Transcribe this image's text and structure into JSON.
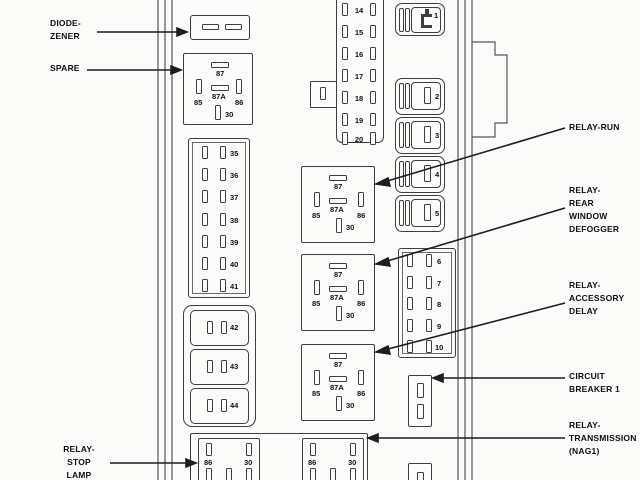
{
  "callouts": {
    "top_partial": "DIODE 2",
    "diode_zener": [
      "DIODE-",
      "ZENER"
    ],
    "spare": [
      "SPARE"
    ],
    "relay_run": [
      "RELAY-RUN"
    ],
    "rear_defogger": [
      "RELAY-",
      "REAR",
      "WINDOW",
      "DEFOGGER"
    ],
    "accessory_delay": [
      "RELAY-",
      "ACCESSORY",
      "DELAY"
    ],
    "circuit_breaker": [
      "CIRCUIT",
      "BREAKER 1"
    ],
    "transmission": [
      "RELAY-",
      "TRANSMISSION",
      "(NAG1)"
    ],
    "stop_lamp": [
      "RELAY-",
      "STOP",
      "LAMP"
    ]
  },
  "relay_pins": {
    "p87": "87",
    "p87a": "87A",
    "p85": "85",
    "p86": "86",
    "p30": "30"
  },
  "fuses": {
    "left_column": [
      "35",
      "36",
      "37",
      "38",
      "39",
      "40",
      "41"
    ],
    "mid_left_boxes": [
      "42",
      "43",
      "44"
    ],
    "top_strip": [
      "14",
      "15",
      "16",
      "17",
      "18",
      "19",
      "20"
    ],
    "cartridge_column": [
      "1",
      "2",
      "3",
      "4",
      "5"
    ],
    "right_block": [
      "6",
      "7",
      "8",
      "9",
      "10"
    ]
  },
  "colors": {
    "line": "#3e3e3e",
    "arrow": "#1d1d1d",
    "background": "#fbfbfa"
  }
}
